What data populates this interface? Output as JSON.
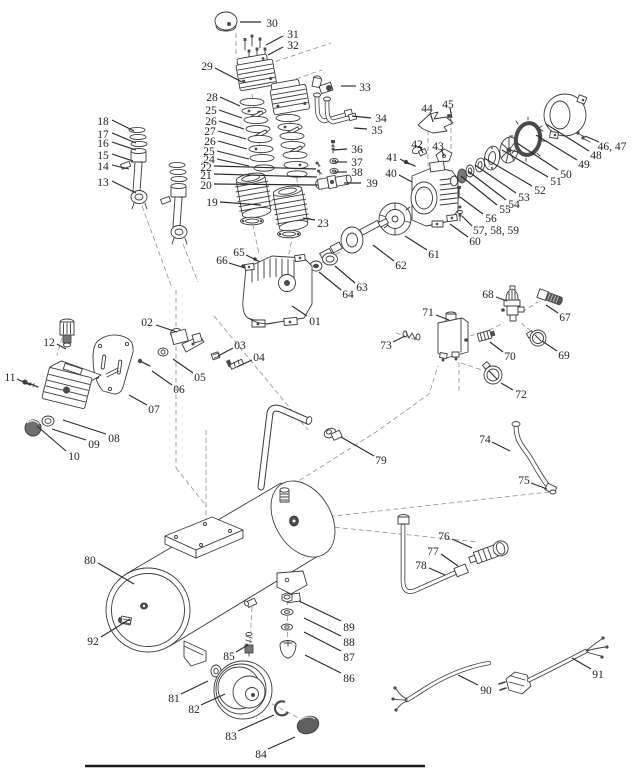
{
  "figure": {
    "type": "exploded-parts-diagram",
    "subject": "air-compressor",
    "background": "#ffffff",
    "ink_color": "#3a3a3a",
    "label_color": "#1f1f1f",
    "leader_color": "#2b2b2b"
  },
  "parts": [
    {
      "t": "01",
      "x": 315,
      "y": 321,
      "l": [
        307,
        316,
        292,
        306
      ]
    },
    {
      "t": "02",
      "x": 147,
      "y": 322,
      "l": [
        156,
        325,
        177,
        332
      ]
    },
    {
      "t": "03",
      "x": 240,
      "y": 345,
      "l": [
        233,
        348,
        218,
        356
      ]
    },
    {
      "t": "04",
      "x": 259,
      "y": 357,
      "l": [
        252,
        360,
        237,
        367
      ]
    },
    {
      "t": "05",
      "x": 200,
      "y": 377,
      "l": [
        193,
        373,
        173,
        359
      ]
    },
    {
      "t": "06",
      "x": 179,
      "y": 389,
      "l": [
        172,
        385,
        152,
        371
      ]
    },
    {
      "t": "07",
      "x": 154,
      "y": 409,
      "l": [
        147,
        405,
        129,
        395
      ]
    },
    {
      "t": "08",
      "x": 114,
      "y": 438,
      "l": [
        106,
        434,
        63,
        420
      ]
    },
    {
      "t": "09",
      "x": 94,
      "y": 444,
      "l": [
        86,
        440,
        52,
        429
      ]
    },
    {
      "t": "10",
      "x": 74,
      "y": 456,
      "l": [
        66,
        451,
        37,
        426
      ]
    },
    {
      "t": "11",
      "x": 10,
      "y": 377,
      "l": [
        17,
        379,
        30,
        385
      ]
    },
    {
      "t": "12",
      "x": 49,
      "y": 342,
      "l": [
        57,
        344,
        66,
        349
      ]
    },
    {
      "t": "13",
      "x": 103,
      "y": 182,
      "l": [
        112,
        181,
        136,
        193
      ]
    },
    {
      "t": "14",
      "x": 103,
      "y": 166,
      "l": [
        112,
        165,
        129,
        169
      ]
    },
    {
      "t": "15",
      "x": 103,
      "y": 155,
      "l": [
        112,
        154,
        133,
        161
      ]
    },
    {
      "t": "16",
      "x": 103,
      "y": 143,
      "l": [
        112,
        142,
        136,
        150
      ]
    },
    {
      "t": "17",
      "x": 103,
      "y": 134,
      "l": [
        112,
        133,
        136,
        143
      ]
    },
    {
      "t": "18",
      "x": 103,
      "y": 121,
      "l": [
        112,
        120,
        134,
        131
      ]
    },
    {
      "t": "19",
      "x": 212,
      "y": 202,
      "l": [
        220,
        202,
        261,
        205
      ]
    },
    {
      "t": "20",
      "x": 206,
      "y": 185,
      "l": [
        214,
        184,
        318,
        185
      ]
    },
    {
      "t": "21",
      "x": 206,
      "y": 175,
      "l": [
        214,
        174,
        317,
        177
      ]
    },
    {
      "t": "22",
      "x": 206,
      "y": 167,
      "l": [
        214,
        166,
        316,
        169
      ]
    },
    {
      "t": "23",
      "x": 323,
      "y": 223,
      "l": [
        315,
        220,
        303,
        218
      ]
    },
    {
      "t": "24",
      "x": 209,
      "y": 159,
      "l": [
        217,
        159,
        249,
        166
      ]
    },
    {
      "t": "25",
      "x": 211,
      "y": 110,
      "l": [
        219,
        110,
        242,
        118
      ]
    },
    {
      "t": "26",
      "x": 211,
      "y": 121,
      "l": [
        219,
        121,
        244,
        129
      ]
    },
    {
      "t": "27",
      "x": 210,
      "y": 131,
      "l": [
        218,
        131,
        246,
        139
      ]
    },
    {
      "t": "26",
      "x": 210,
      "y": 141,
      "l": [
        218,
        141,
        247,
        149
      ]
    },
    {
      "t": "25",
      "x": 209,
      "y": 151,
      "l": [
        217,
        151,
        249,
        159
      ]
    },
    {
      "t": "28",
      "x": 212,
      "y": 97,
      "l": [
        220,
        97,
        240,
        106
      ]
    },
    {
      "t": "29",
      "x": 207,
      "y": 66,
      "l": [
        215,
        68,
        242,
        82
      ]
    },
    {
      "t": "30",
      "x": 272,
      "y": 23,
      "l": [
        261,
        22,
        240,
        22
      ]
    },
    {
      "t": "31",
      "x": 293,
      "y": 34,
      "l": [
        283,
        36,
        266,
        45
      ]
    },
    {
      "t": "32",
      "x": 293,
      "y": 45,
      "l": [
        283,
        47,
        268,
        55
      ]
    },
    {
      "t": "33",
      "x": 365,
      "y": 87,
      "l": [
        356,
        86,
        341,
        86
      ]
    },
    {
      "t": "34",
      "x": 381,
      "y": 118,
      "l": [
        371,
        118,
        352,
        116
      ]
    },
    {
      "t": "35",
      "x": 377,
      "y": 130,
      "l": [
        367,
        129,
        354,
        128
      ]
    },
    {
      "t": "36",
      "x": 357,
      "y": 149,
      "l": [
        347,
        149,
        333,
        150
      ]
    },
    {
      "t": "37",
      "x": 357,
      "y": 162,
      "l": [
        347,
        162,
        334,
        162
      ]
    },
    {
      "t": "38",
      "x": 357,
      "y": 172,
      "l": [
        347,
        172,
        334,
        172
      ]
    },
    {
      "t": "39",
      "x": 372,
      "y": 183,
      "l": [
        361,
        183,
        344,
        183
      ]
    },
    {
      "t": "40",
      "x": 391,
      "y": 173,
      "l": [
        399,
        175,
        412,
        182
      ]
    },
    {
      "t": "41",
      "x": 392,
      "y": 157,
      "l": [
        400,
        159,
        409,
        164
      ]
    },
    {
      "t": "42",
      "x": 417,
      "y": 144,
      "l": [
        420,
        147,
        423,
        153
      ]
    },
    {
      "t": "43",
      "x": 438,
      "y": 146,
      "l": [
        441,
        149,
        444,
        156
      ]
    },
    {
      "t": "44",
      "x": 427,
      "y": 108,
      "l": [
        430,
        112,
        433,
        122
      ]
    },
    {
      "t": "45",
      "x": 448,
      "y": 104,
      "l": [
        450,
        108,
        452,
        118
      ]
    },
    {
      "t": "46, 47",
      "x": 612,
      "y": 146,
      "l": [
        599,
        142,
        585,
        136
      ]
    },
    {
      "t": "48",
      "x": 596,
      "y": 155,
      "l": [
        589,
        151,
        546,
        124
      ]
    },
    {
      "t": "49",
      "x": 584,
      "y": 164,
      "l": [
        577,
        160,
        536,
        135
      ]
    },
    {
      "t": "50",
      "x": 566,
      "y": 174,
      "l": [
        558,
        170,
        517,
        143
      ]
    },
    {
      "t": "51",
      "x": 556,
      "y": 181,
      "l": [
        548,
        177,
        502,
        150
      ]
    },
    {
      "t": "52",
      "x": 540,
      "y": 190,
      "l": [
        532,
        186,
        484,
        158
      ]
    },
    {
      "t": "53",
      "x": 524,
      "y": 197,
      "l": [
        516,
        193,
        475,
        165
      ]
    },
    {
      "t": "54",
      "x": 514,
      "y": 204,
      "l": [
        506,
        200,
        468,
        171
      ]
    },
    {
      "t": "55",
      "x": 505,
      "y": 209,
      "l": [
        497,
        205,
        461,
        176
      ]
    },
    {
      "t": "56",
      "x": 491,
      "y": 218,
      "l": [
        483,
        214,
        460,
        197
      ]
    },
    {
      "t": "57, 58, 59",
      "x": 496,
      "y": 230,
      "l": [
        472,
        226,
        462,
        216
      ]
    },
    {
      "t": "60",
      "x": 475,
      "y": 241,
      "l": [
        468,
        237,
        450,
        224
      ]
    },
    {
      "t": "61",
      "x": 434,
      "y": 254,
      "l": [
        427,
        250,
        405,
        236
      ]
    },
    {
      "t": "62",
      "x": 401,
      "y": 265,
      "l": [
        394,
        261,
        373,
        245
      ]
    },
    {
      "t": "63",
      "x": 362,
      "y": 287,
      "l": [
        355,
        283,
        335,
        266
      ]
    },
    {
      "t": "64",
      "x": 348,
      "y": 294,
      "l": [
        341,
        290,
        319,
        272
      ]
    },
    {
      "t": "65",
      "x": 239,
      "y": 252,
      "l": [
        246,
        255,
        258,
        261
      ]
    },
    {
      "t": "66",
      "x": 222,
      "y": 260,
      "l": [
        229,
        263,
        245,
        268
      ]
    },
    {
      "t": "67",
      "x": 565,
      "y": 317,
      "l": [
        558,
        313,
        546,
        305
      ]
    },
    {
      "t": "68",
      "x": 488,
      "y": 294,
      "l": [
        496,
        297,
        507,
        301
      ]
    },
    {
      "t": "69",
      "x": 564,
      "y": 355,
      "l": [
        557,
        351,
        542,
        341
      ]
    },
    {
      "t": "70",
      "x": 510,
      "y": 356,
      "l": [
        503,
        352,
        490,
        342
      ]
    },
    {
      "t": "71",
      "x": 428,
      "y": 312,
      "l": [
        436,
        315,
        449,
        320
      ]
    },
    {
      "t": "72",
      "x": 521,
      "y": 394,
      "l": [
        513,
        390,
        501,
        383
      ]
    },
    {
      "t": "73",
      "x": 386,
      "y": 345,
      "l": [
        393,
        342,
        405,
        336
      ]
    },
    {
      "t": "74",
      "x": 485,
      "y": 439,
      "l": [
        492,
        442,
        510,
        451
      ]
    },
    {
      "t": "75",
      "x": 524,
      "y": 480,
      "l": [
        531,
        483,
        547,
        489
      ]
    },
    {
      "t": "76",
      "x": 444,
      "y": 536,
      "l": [
        452,
        539,
        472,
        548
      ]
    },
    {
      "t": "77",
      "x": 433,
      "y": 551,
      "l": [
        441,
        554,
        458,
        566
      ]
    },
    {
      "t": "78",
      "x": 421,
      "y": 565,
      "l": [
        429,
        568,
        445,
        575
      ]
    },
    {
      "t": "79",
      "x": 381,
      "y": 460,
      "l": [
        374,
        456,
        341,
        437
      ]
    },
    {
      "t": "80",
      "x": 90,
      "y": 560,
      "l": [
        98,
        563,
        134,
        584
      ]
    },
    {
      "t": "81",
      "x": 174,
      "y": 698,
      "l": [
        181,
        694,
        208,
        681
      ]
    },
    {
      "t": "82",
      "x": 194,
      "y": 709,
      "l": [
        201,
        705,
        225,
        694
      ]
    },
    {
      "t": "83",
      "x": 231,
      "y": 736,
      "l": [
        238,
        731,
        274,
        715
      ]
    },
    {
      "t": "84",
      "x": 261,
      "y": 754,
      "l": [
        268,
        749,
        295,
        737
      ]
    },
    {
      "t": "85",
      "x": 229,
      "y": 656,
      "l": [
        236,
        652,
        248,
        645
      ]
    },
    {
      "t": "86",
      "x": 349,
      "y": 678,
      "l": [
        341,
        673,
        305,
        655
      ]
    },
    {
      "t": "87",
      "x": 349,
      "y": 657,
      "l": [
        341,
        651,
        304,
        632
      ]
    },
    {
      "t": "88",
      "x": 349,
      "y": 642,
      "l": [
        341,
        636,
        304,
        618
      ]
    },
    {
      "t": "89",
      "x": 349,
      "y": 627,
      "l": [
        341,
        621,
        299,
        601
      ]
    },
    {
      "t": "90",
      "x": 486,
      "y": 690,
      "l": [
        478,
        685,
        458,
        675
      ]
    },
    {
      "t": "91",
      "x": 598,
      "y": 674,
      "l": [
        591,
        669,
        572,
        658
      ]
    },
    {
      "t": "92",
      "x": 93,
      "y": 641,
      "l": [
        101,
        637,
        130,
        619
      ]
    }
  ]
}
